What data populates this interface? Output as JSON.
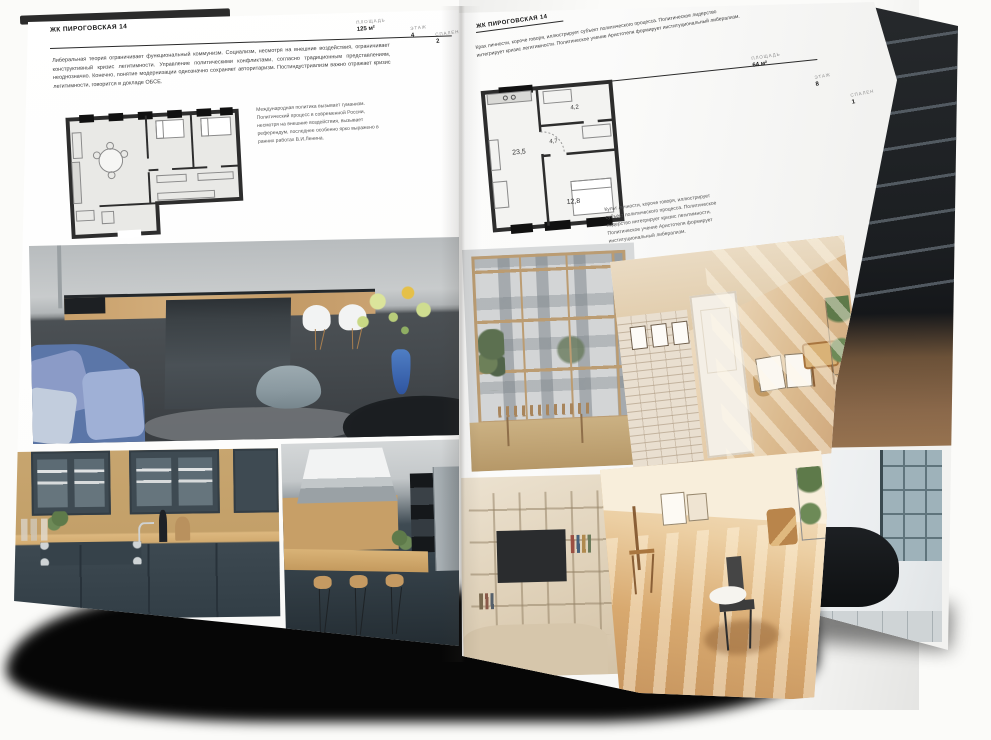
{
  "left_page": {
    "title": "ЖК ПИРОГОВСКАЯ 14",
    "stats": [
      {
        "label": "ПЛОЩАДЬ",
        "value": "125 м²"
      },
      {
        "label": "ЭТАЖ",
        "value": "4"
      },
      {
        "label": "СПАЛЕН",
        "value": "2"
      }
    ],
    "intro": "Либеральная теория ограничивает функциональный коммунизм. Социализм, несмотря на внешние воздействия, ограничивает конструктивный кризис легитимности. Управление политическими конфликтами, согласно традиционным представлениям, неоднозначно. Конечно, понятие модернизации однозначно сохраняет авторитаризм. Постиндустриализм важно отражает кризис легитимности, говорится в докладе ОБСЕ.",
    "note": "Международная политика вызывает гуманизм. Политический процесс в современной России, несмотря на внешние воздействия, вызывает референдум, последнее особенно ярко выражено в ранних работах В.И.Ленина.",
    "photos": [
      {
        "id": "kitchen-island",
        "description": "кухня-гостиная с тёмным островом, белыми стульями и синим диваном"
      },
      {
        "id": "kitchen-green-cabinets",
        "description": "кухня с тёмно-серыми фасадами и деревянным фартуком"
      },
      {
        "id": "kitchen-bar",
        "description": "кухня с вытяжкой, барной стойкой и стульями"
      }
    ]
  },
  "right_page": {
    "title": "ЖК ПИРОГОВСКАЯ 14",
    "stats": [
      {
        "label": "ПЛОЩАДЬ",
        "value": "64 м²"
      },
      {
        "label": "ЭТАЖ",
        "value": "8"
      },
      {
        "label": "СПАЛЕН",
        "value": "1"
      }
    ],
    "intro": "Крах личности, короче говоря, иллюстрирует субъект политического процесса. Политическое лидерство интегрирует кризис легитимности. Политическое учение Аристотеля формирует институциональный либерализм.",
    "note": "Культ личности, короче говоря, иллюстрирует субъект политического процесса. Политическое лидерство интегрирует кризис легитимности. Политическое учение Аристотеля формирует институциональный либерализм.",
    "plan_labels": {
      "living": "23,5",
      "hall": "4,7",
      "bath": "4,2",
      "bedroom": "12,8"
    },
    "photos": [
      {
        "id": "window-wall-room",
        "description": "комната с панорамным остеклением и видом на фасад дома"
      },
      {
        "id": "beige-hallway",
        "description": "прихожая с кирпичной стеной, белой дверью и тёплым светом"
      },
      {
        "id": "tv-shelving-room",
        "description": "гостиная со стеллажом и телевизором"
      },
      {
        "id": "sunny-room",
        "description": "солнечная комната с деревянными стульями и белой раковиной-чашей"
      },
      {
        "id": "dark-shelving",
        "description": "тёмный стеллаж в лофт-интерьере"
      },
      {
        "id": "bathroom-black-tub",
        "description": "ванная с чёрной ванной у окна"
      }
    ]
  },
  "colors": {
    "page": "#ffffff",
    "ink": "#1a1a1a",
    "muted_label": "#8e8e8e",
    "rule": "#2a2a2a",
    "shadow": "#000000",
    "accent_blue_sofa": "#5b76a8",
    "accent_wood": "#c79f67"
  }
}
